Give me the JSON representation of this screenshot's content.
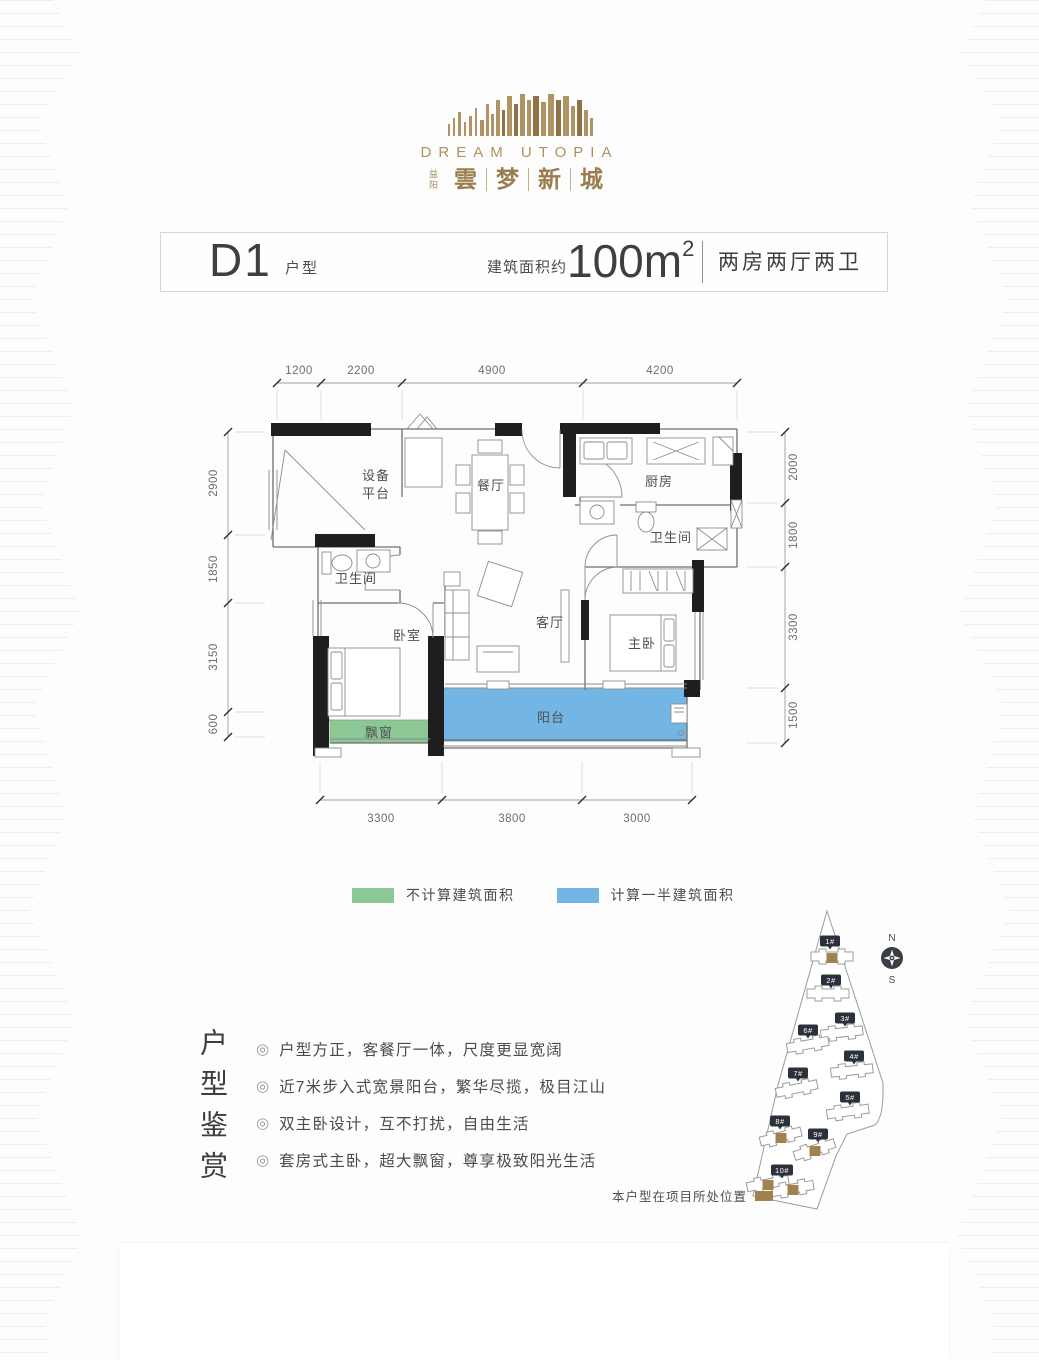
{
  "logo": {
    "en": "DREAM UTOPIA",
    "city": "益阳",
    "cn_chars": [
      "雲",
      "梦",
      "新",
      "城"
    ],
    "accent": "#ae9264"
  },
  "titlebar": {
    "unit_code": "D1",
    "unit_label": "户型",
    "area_prefix": "建筑面积约",
    "area_value": "100m",
    "area_sup": "2",
    "rooms_summary": "两房两厅两卫"
  },
  "plan": {
    "rooms": {
      "equipment_1": "设备",
      "equipment_2": "平台",
      "dining": "餐厅",
      "kitchen": "厨房",
      "bath_master": "卫生间",
      "bath_guest": "卫生间",
      "bedroom": "卧室",
      "living": "客厅",
      "master": "主卧",
      "balcony": "阳台",
      "bay_window": "飘窗"
    },
    "dims": {
      "top": [
        "1200",
        "2200",
        "4900",
        "4200"
      ],
      "left": [
        "2900",
        "1850",
        "3150",
        "600"
      ],
      "right": [
        "2000",
        "1800",
        "3300",
        "1500"
      ],
      "bottom": [
        "3300",
        "3800",
        "3000"
      ]
    },
    "colors": {
      "bay_window": "#8cc795",
      "balcony": "#73b6e4"
    }
  },
  "legend": {
    "items": [
      {
        "label": "不计算建筑面积",
        "color": "#8cc795"
      },
      {
        "label": "计算一半建筑面积",
        "color": "#73b6e4"
      }
    ]
  },
  "features": {
    "title": "户型鉴赏",
    "bullet": "◎",
    "items": [
      "户型方正，客餐厅一体，尺度更显宽阔",
      "近7米步入式宽景阳台，繁华尽揽，极目江山",
      "双主卧设计，互不打扰，自由生活",
      "套房式主卧，超大飘窗，尊享极致阳光生活"
    ]
  },
  "sitemap": {
    "buildings": [
      "1#",
      "2#",
      "3#",
      "4#",
      "5#",
      "6#",
      "7#",
      "8#",
      "9#",
      "10#"
    ],
    "compass_n": "N",
    "compass_s": "S",
    "caption": "本户型在项目所处位置",
    "marker_color": "#a1814e"
  }
}
